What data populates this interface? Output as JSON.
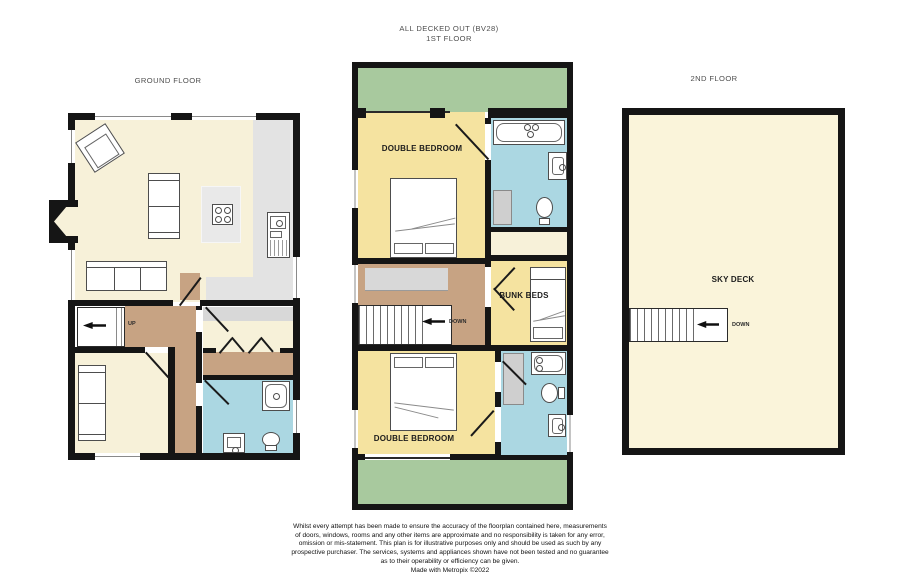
{
  "colors": {
    "wall": "#151515",
    "living_cream": "#f7f1d9",
    "bedroom_yellow": "#f5e3a0",
    "bathroom_blue": "#abd7e2",
    "deck_green": "#a8c99e",
    "hall_brown": "#c7a383",
    "kitchen_gray": "#e3e3e3",
    "skydeck_cream": "#faf4da"
  },
  "titles": {
    "heading_line1": "ALL DECKED OUT (BV28)",
    "heading_line2": "1ST FLOOR",
    "ground_floor": "GROUND FLOOR",
    "second_floor": "2ND FLOOR"
  },
  "rooms": {
    "first_bedroom_top": "DOUBLE BEDROOM",
    "first_bunk": "BUNK BEDS",
    "first_bedroom_bottom": "DOUBLE BEDROOM",
    "second_skydeck": "SKY DECK"
  },
  "stairs": {
    "ground_up": "UP",
    "first_down": "DOWN",
    "second_down": "DOWN"
  },
  "footer": {
    "lines": [
      "Whilst every attempt has been made to ensure the accuracy of the floorplan contained here, measurements",
      "of doors, windows, rooms and any other items are approximate and no responsibility is taken for any error,",
      "omission or mis-statement. This plan is for illustrative purposes only and should be used as such by any",
      "prospective purchaser. The services, systems and appliances shown have not been tested and no guarantee",
      "as to their operability or efficiency can be given."
    ],
    "credit": "Made with Metropix ©2022"
  }
}
